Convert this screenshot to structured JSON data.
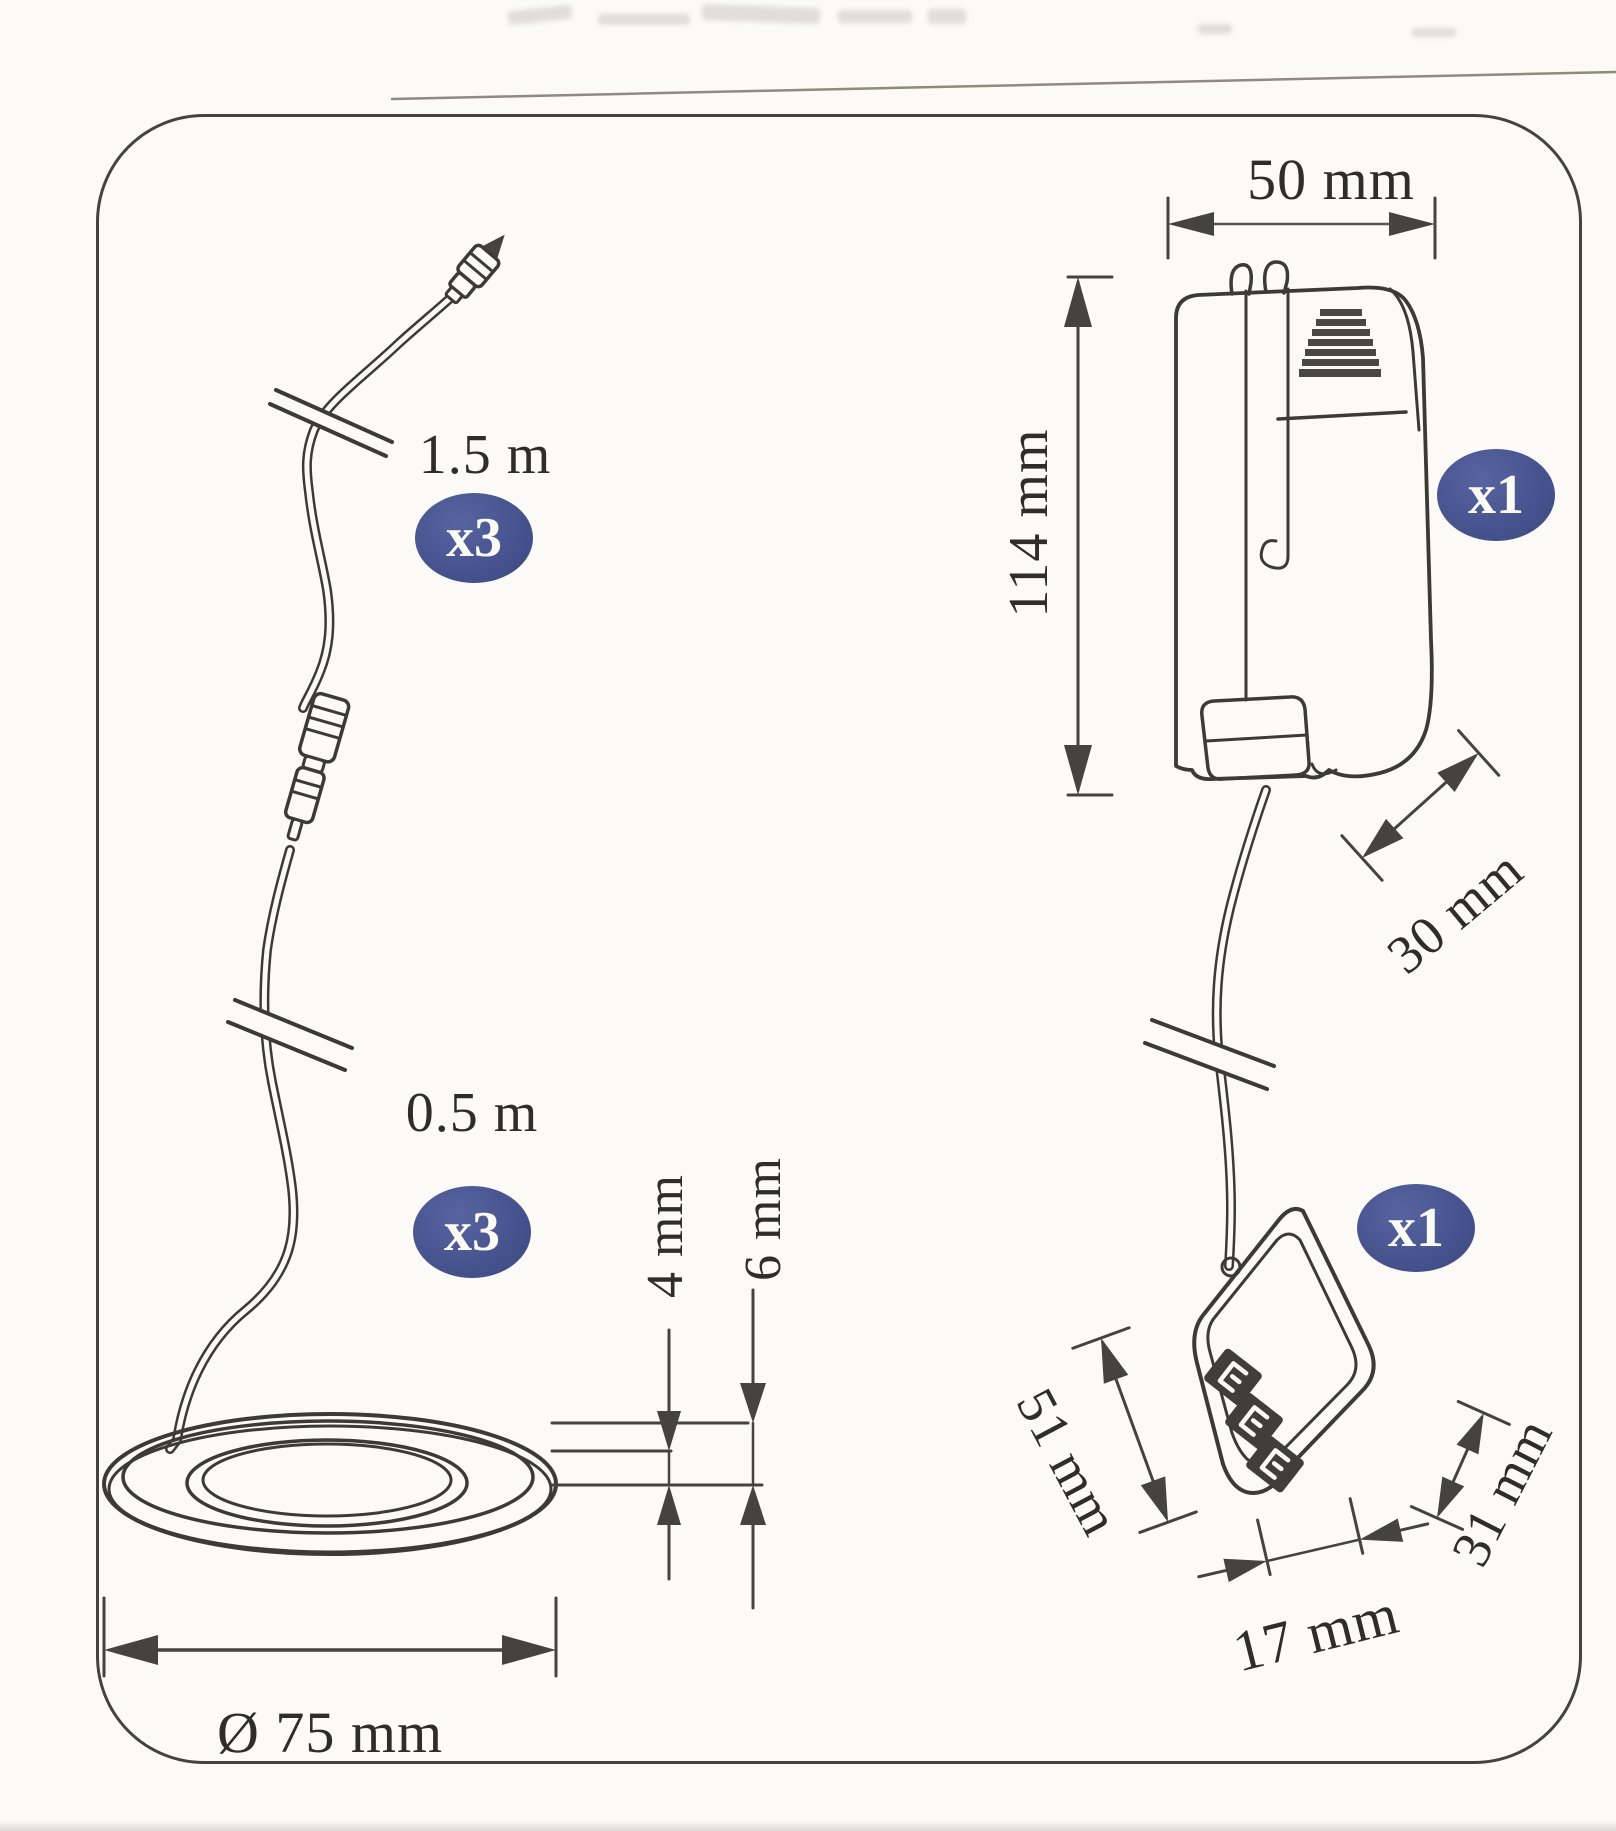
{
  "diagram": {
    "description": "lighting kit parts dimensions",
    "accent_color": "#47548f",
    "line_color": "#3c3a35",
    "kit_items": {
      "extension_cable": {
        "length_label": "1.5 m",
        "quantity_badge": "x3"
      },
      "puck_light": {
        "cable_length_label": "0.5 m",
        "quantity_badge": "x3",
        "diameter_label": "Ø 75 mm",
        "recess_height_label": "4 mm",
        "total_height_label": "6 mm"
      },
      "driver": {
        "width_label": "50 mm",
        "height_label": "114 mm",
        "depth_label": "30 mm",
        "quantity_badge": "x1"
      },
      "distributor": {
        "length_label": "51 mm",
        "width_label": "17 mm",
        "height_label": "31 mm",
        "quantity_badge": "x1"
      }
    }
  }
}
